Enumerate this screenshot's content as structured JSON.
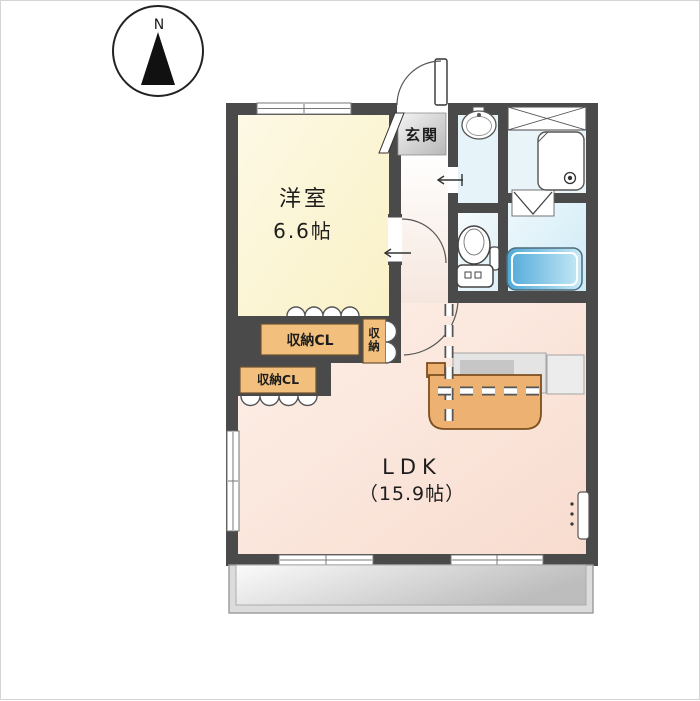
{
  "compass": {
    "label": "N"
  },
  "plan": {
    "western_room": {
      "name": "洋室",
      "size": "6.6帖"
    },
    "entrance": {
      "name": "玄関"
    },
    "ldk": {
      "name": "LDK",
      "size": "（15.9帖）"
    },
    "closet_upper": {
      "label": "収納CL"
    },
    "closet_lower": {
      "label": "収納CL"
    },
    "closet_side": {
      "char1": "収",
      "char2": "納"
    }
  },
  "icons": [
    "compass-icon",
    "entrance-door-arc",
    "shoe-cabinet",
    "washbasin-icon",
    "storage-shelf-cross",
    "washing-machine-pan",
    "folding-bath-door",
    "bathtub-icon",
    "toilet-icon",
    "kitchen-counter",
    "kitchen-island",
    "closet-folding-doors",
    "door-arc",
    "sliding-door-arrow",
    "window",
    "sliding-window",
    "slit-window",
    "balcony"
  ],
  "colors": {
    "wall": "#4a4a4a",
    "western_room": "#fbf6d6",
    "ldk": "#f9e2d5",
    "hall": "#f7ece6",
    "water_rooms": "#e3f2f8",
    "bathtub": "#58b0dd",
    "closet": "#f2c07c",
    "kitchen_island": "#edb172",
    "counter": "#d9d9d9",
    "entrance_floor": "#cfcfcf",
    "balcony": "#d9d9d9"
  }
}
